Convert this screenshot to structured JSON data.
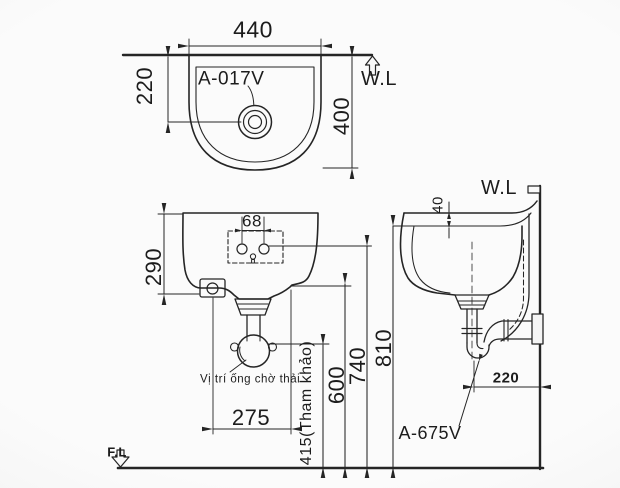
{
  "top_view": {
    "width_dim": "440",
    "offset_dim": "220",
    "depth_dim": "400",
    "part_label": "A-017V",
    "water_line_label": "W.L"
  },
  "front_view": {
    "hole_pitch_dim": "68",
    "height_dim": "290",
    "waste_note": "Vị trí ống chờ thải",
    "bottom_width_dim": "275",
    "ref_height_dim": "415(Tham khảo)",
    "drain_height_dim": "600",
    "hole_height_dim": "740",
    "rim_height_dim": "810"
  },
  "side_view": {
    "water_line_label": "W.L",
    "rim_gap_dim": "40",
    "trap_offset_dim": "220",
    "trap_part_label": "A-675V"
  },
  "floor_line_label": "F.L"
}
